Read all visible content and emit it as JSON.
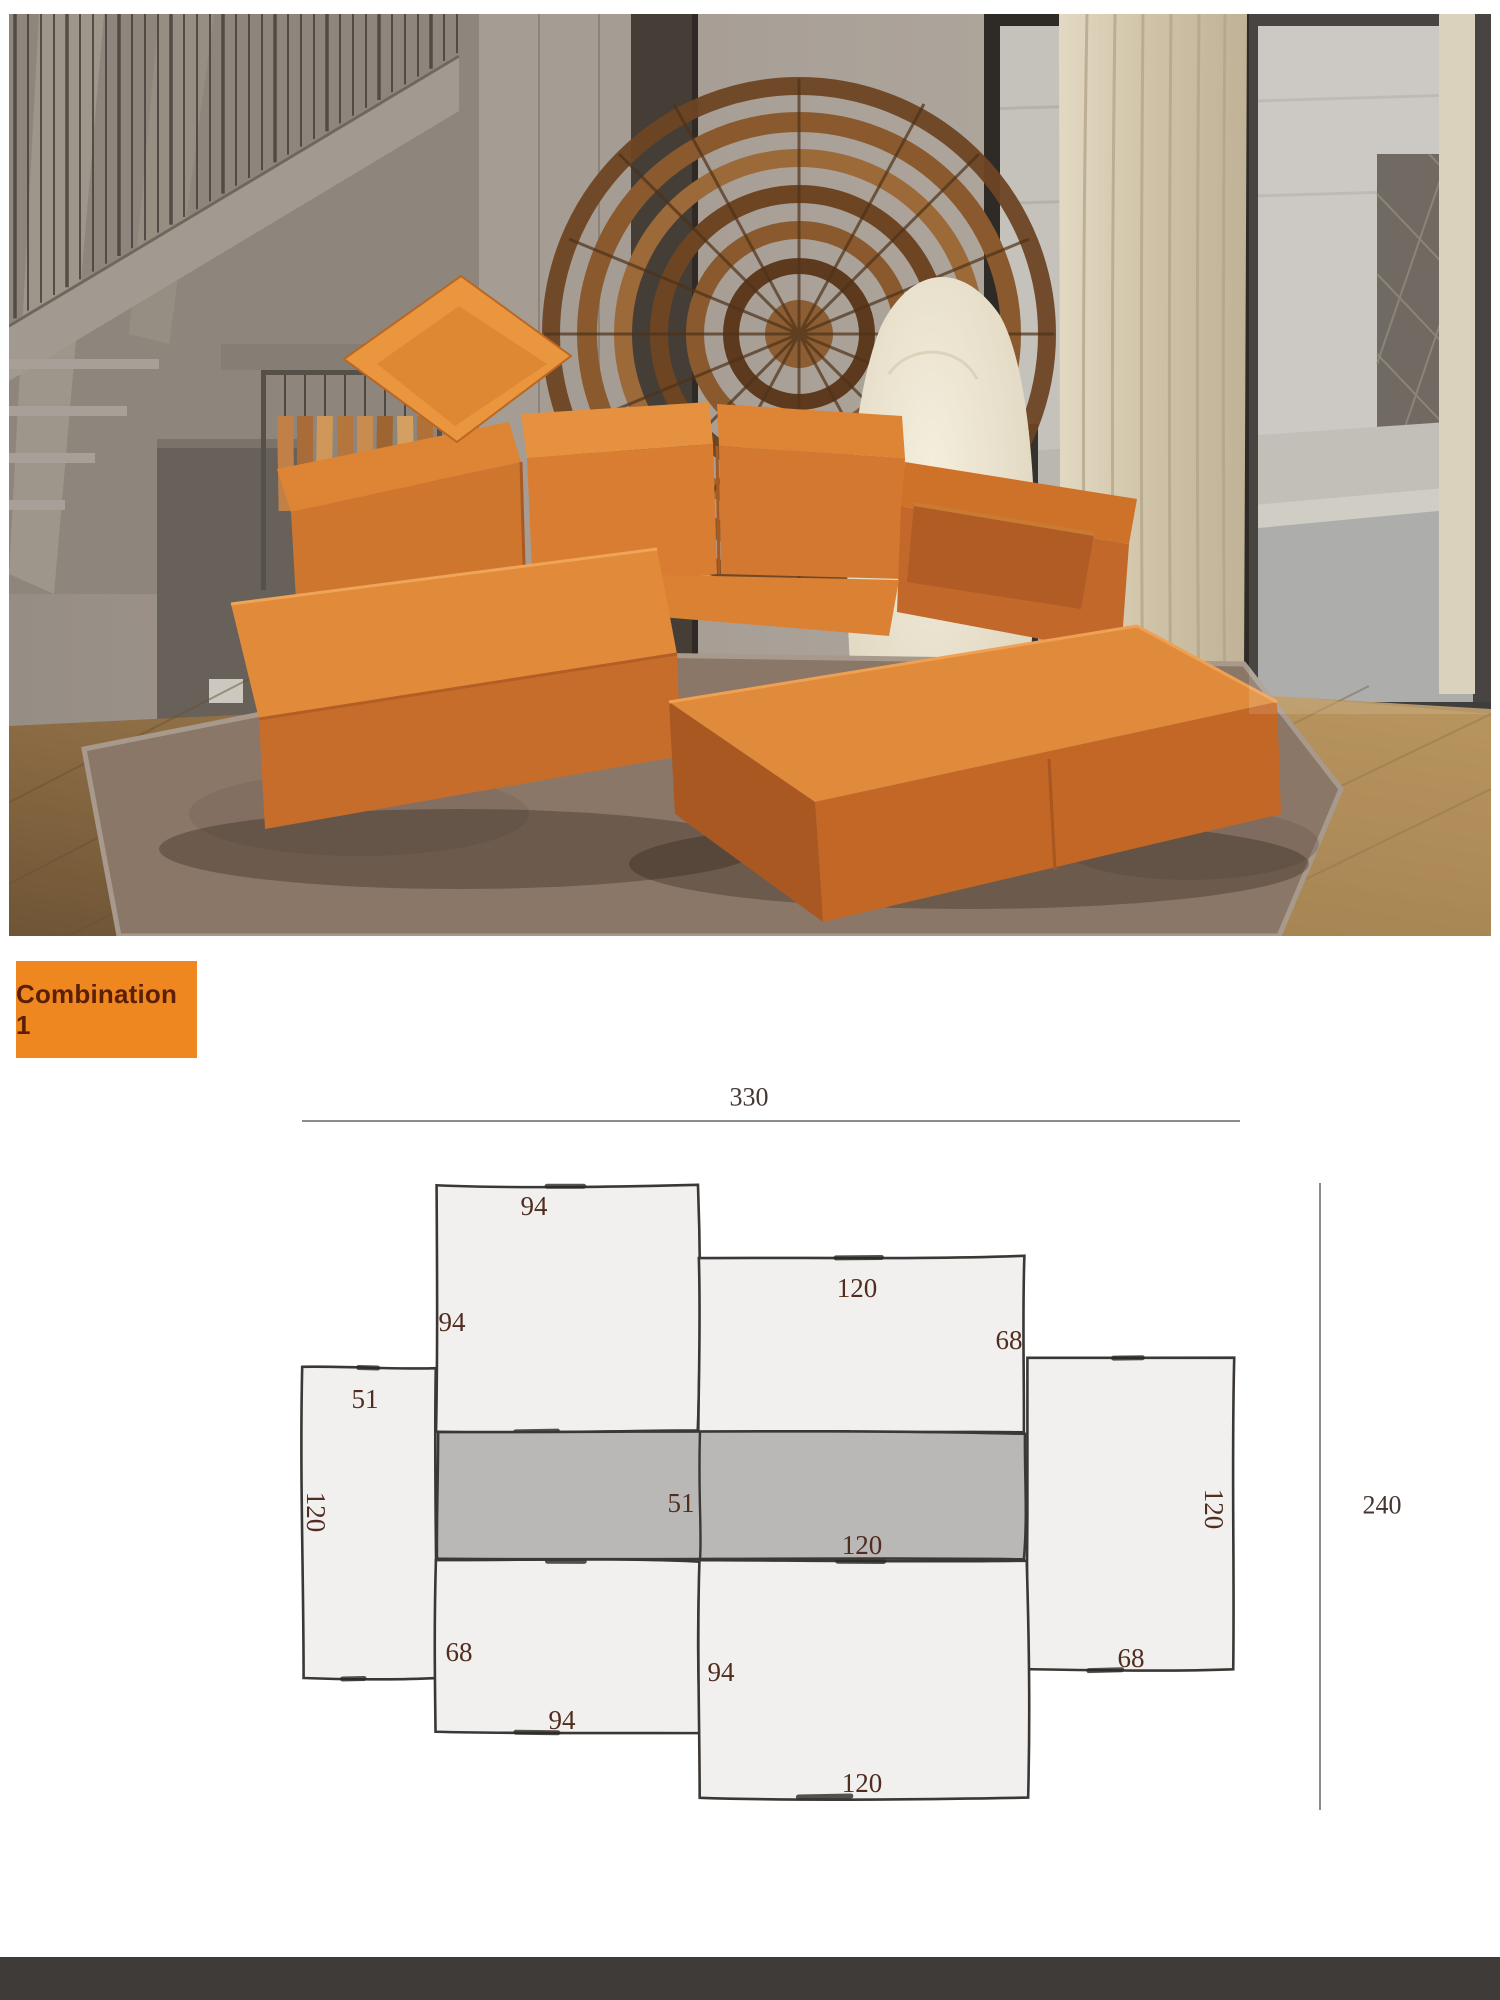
{
  "photo": {
    "description": "Showroom photo: orange block modular leather sofa on a brown rug, staircase and leather-sample rack at left, round woven fan screen, cream high-back armchair, glass wall with street view and beige curtain at right",
    "colors": {
      "sofa_orange": "#DD8434",
      "sofa_shadow": "#B15D23",
      "pillow_orange": "#EA963E",
      "rug_taupe": "#8B7767",
      "floor_wood": "#96754A",
      "curtain_beige": "#D9CEB8",
      "chair_cream": "#EFE8D6",
      "street_gray": "#C9C7C2"
    }
  },
  "combination_label": {
    "text": "Combination 1",
    "bg": "#EE8720",
    "fg": "#5B1F05"
  },
  "diagram": {
    "style": {
      "fill_light": "#F1F0EE",
      "fill_dark": "#B9B8B6",
      "stroke": "#3A3734",
      "accent": "#2C2926",
      "label_color": "#512D20",
      "dim_color": "#463631",
      "line_color": "#8C8C8C"
    },
    "dimension_lines": [
      {
        "name": "overall-width",
        "label": "330",
        "x1": 302,
        "y1": 1121,
        "x2": 1240,
        "y2": 1121,
        "lx": 749,
        "ly": 1097
      },
      {
        "name": "overall-height",
        "label": "240",
        "x1": 1320,
        "y1": 1183,
        "x2": 1320,
        "y2": 1810,
        "lx": 1382,
        "ly": 1505
      }
    ],
    "seam": {
      "x": 700,
      "y1": 1432,
      "y2": 1560
    },
    "modules": [
      {
        "name": "module-left-arm",
        "rect": [
          302,
          1367,
          135,
          311
        ],
        "shade": "light",
        "labels": [
          {
            "text": "51",
            "x": 365,
            "y": 1399
          },
          {
            "text": "120",
            "x": 316,
            "y": 1512,
            "rotate": 90
          }
        ]
      },
      {
        "name": "module-back-left",
        "rect": [
          437,
          1186,
          262,
          246
        ],
        "shade": "light",
        "labels": [
          {
            "text": "94",
            "x": 534,
            "y": 1206
          },
          {
            "text": "94",
            "x": 452,
            "y": 1322
          }
        ]
      },
      {
        "name": "module-back-right",
        "rect": [
          699,
          1257,
          326,
          175
        ],
        "shade": "light",
        "labels": [
          {
            "text": "120",
            "x": 857,
            "y": 1288
          },
          {
            "text": "68",
            "x": 1009,
            "y": 1340
          }
        ]
      },
      {
        "name": "module-right-arm",
        "rect": [
          1027,
          1357,
          206,
          313
        ],
        "shade": "light",
        "labels": [
          {
            "text": "120",
            "x": 1214,
            "y": 1509,
            "rotate": 90
          },
          {
            "text": "68",
            "x": 1131,
            "y": 1658
          }
        ]
      },
      {
        "name": "module-seat-left",
        "rect": [
          437,
          1560,
          263,
          173
        ],
        "shade": "light",
        "labels": [
          {
            "text": "68",
            "x": 459,
            "y": 1652
          },
          {
            "text": "94",
            "x": 562,
            "y": 1720
          }
        ]
      },
      {
        "name": "module-seat-right",
        "rect": [
          700,
          1560,
          328,
          238
        ],
        "shade": "light",
        "labels": [
          {
            "text": "94",
            "x": 721,
            "y": 1672
          },
          {
            "text": "120",
            "x": 862,
            "y": 1783
          }
        ]
      },
      {
        "name": "module-back-band",
        "rect": [
          438,
          1432,
          587,
          128
        ],
        "shade": "dark",
        "labels": [
          {
            "text": "51",
            "x": 681,
            "y": 1503
          },
          {
            "text": "120",
            "x": 862,
            "y": 1545
          }
        ]
      }
    ]
  },
  "footer": {
    "bg": "#3E3B39"
  }
}
